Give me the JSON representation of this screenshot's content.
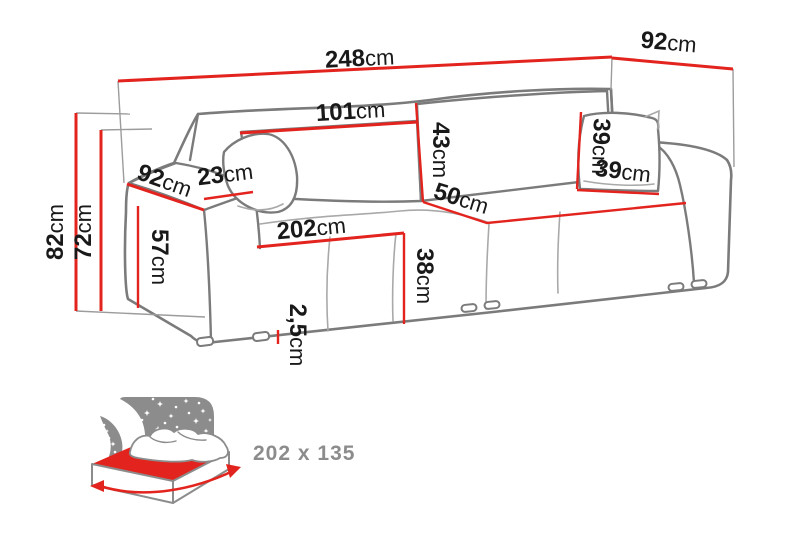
{
  "diagram": {
    "type": "sofa-dimension-drawing",
    "unit": "cm"
  },
  "measurements": {
    "total_width": {
      "value": "248",
      "unit": "cm"
    },
    "total_depth": {
      "value": "92",
      "unit": "cm"
    },
    "backrest_cushion_width": {
      "value": "101",
      "unit": "cm"
    },
    "backrest_cushion_height": {
      "value": "43",
      "unit": "cm"
    },
    "seat_depth": {
      "value": "50",
      "unit": "cm"
    },
    "seat_front_width": {
      "value": "202",
      "unit": "cm"
    },
    "seat_height": {
      "value": "38",
      "unit": "cm"
    },
    "leg_height": {
      "value": "2,5",
      "unit": "cm"
    },
    "armrest_depth": {
      "value": "92",
      "unit": "cm"
    },
    "armrest_width": {
      "value": "23",
      "unit": "cm"
    },
    "armrest_height": {
      "value": "57",
      "unit": "cm"
    },
    "total_height": {
      "value": "82",
      "unit": "cm"
    },
    "body_height": {
      "value": "72",
      "unit": "cm"
    },
    "pillow_height": {
      "value": "39",
      "unit": "cm"
    },
    "pillow_width": {
      "value": "39",
      "unit": "cm"
    }
  },
  "sleeping_area": {
    "label": "202 x 135"
  },
  "colors": {
    "dimension_red": "#e3241e",
    "outline_gray": "#7b7b7b",
    "label_black": "#191919",
    "icon_gray": "#8c8c8c",
    "background": "#ffffff"
  }
}
